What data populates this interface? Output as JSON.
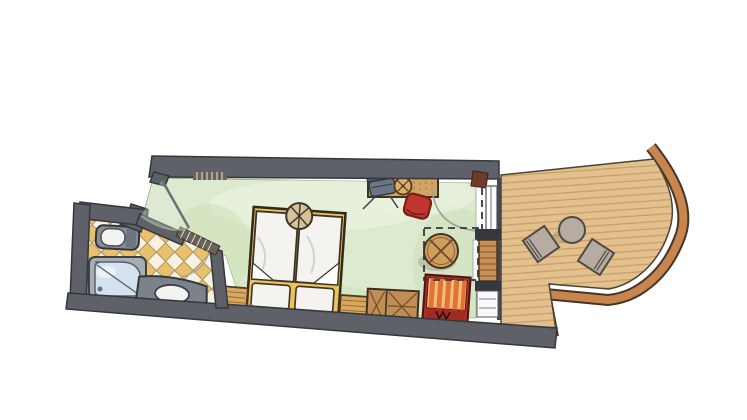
{
  "scene": {
    "type": "floor-plan",
    "description_elements": [
      "bathroom",
      "bedroom",
      "balcony"
    ]
  },
  "colors": {
    "wall": "#5e6167",
    "wallOutline": "#34373c",
    "floorGreen": "#dcead0",
    "floorGreenShade": "#cde0b4",
    "floorGreenLight": "#edf3e1",
    "tileYellow": "#e9c06b",
    "tileWhite": "#f6f1e2",
    "tileLine": "#ab9264",
    "deck": "#e3c18e",
    "deckLine": "#bf8d55",
    "rail": "#c8854e",
    "railOutline": "#473526",
    "bedFrame": "#eec25b",
    "duvet": "#f4f3ef",
    "bedHeadCircle": "#d6c298",
    "deskWood": "#d2a464",
    "deskGrain": "#a87c44",
    "wardrobeWood": "#c08e55",
    "nightstandWood": "#d8a862",
    "tableWood": "#cf9e5c",
    "sillWood": "#c89055",
    "redChair": "#c23630",
    "benchRed": "#b5312b",
    "stripeOrange": "#e0742f",
    "stripeLight": "#f3ba85",
    "deskChairGray": "#6a7585",
    "deskChairBack": "#4c5666",
    "balconyFurniture": "#b6aca1",
    "fixtureGray": "#878d96",
    "counterGray": "#7c828c",
    "showerTray": "#d4e2ef",
    "porcelain": "#f3f4f2",
    "doorFrameRed": "#6e3b2a",
    "lamp": "#d8b06c",
    "arc": "#9aa39a"
  },
  "rooms": {
    "bathroom": {
      "floor": "diagonal-checkered-tiles",
      "fixtures": [
        "toilet",
        "shower",
        "sink-vanity"
      ]
    },
    "bedroom": {
      "floor": "green-wash",
      "furniture": [
        "double-bed",
        "bedside-light",
        "nightstand-left",
        "nightstand-right",
        "wardrobe",
        "striped-bench",
        "desk",
        "desk-chair",
        "red-armchair",
        "round-table-dashed-zone"
      ]
    },
    "balcony": {
      "floor": "wood-plank-deck",
      "furniture": [
        "round-table",
        "chair-left",
        "chair-right"
      ],
      "edge": "curved-rail"
    }
  }
}
